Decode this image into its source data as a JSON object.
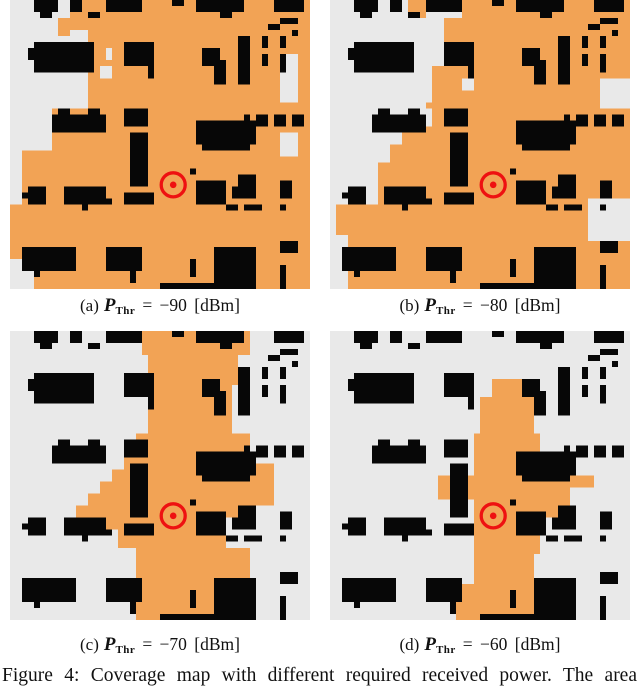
{
  "figure": {
    "caption": "Figure 4: Coverage map with different required received power. The area",
    "math": {
      "symbol": "P",
      "subscript": "Thr"
    },
    "panels": [
      {
        "label": "(a)",
        "rest": "= −90 [dBm]",
        "threshold_dbm": -90,
        "coverage": [
          [
            13,
            0,
            37,
            48
          ],
          [
            10,
            0,
            3,
            5
          ],
          [
            8,
            3,
            2,
            3
          ],
          [
            7,
            18,
            6,
            30
          ],
          [
            2,
            25,
            5,
            23
          ],
          [
            0,
            34,
            2,
            9
          ]
        ],
        "gray_patches": [
          [
            45,
            9,
            3,
            8
          ],
          [
            45,
            22,
            3,
            4
          ],
          [
            0,
            43,
            2,
            5
          ],
          [
            2,
            45,
            2,
            3
          ],
          [
            16,
            8,
            1,
            2
          ],
          [
            15,
            11,
            2,
            2
          ]
        ]
      },
      {
        "label": "(b)",
        "rest": "= −80 [dBm]",
        "threshold_dbm": -80,
        "coverage": [
          [
            22,
            0,
            28,
            48
          ],
          [
            19,
            3,
            3,
            45
          ],
          [
            17,
            11,
            2,
            37
          ],
          [
            13,
            0,
            3,
            3
          ],
          [
            16,
            17,
            1,
            1
          ],
          [
            12,
            21,
            5,
            27
          ],
          [
            10,
            24,
            2,
            24
          ],
          [
            8,
            27,
            2,
            21
          ],
          [
            1,
            34,
            7,
            5
          ],
          [
            3,
            39,
            9,
            9
          ]
        ],
        "gray_patches": [
          [
            45,
            13,
            5,
            5
          ],
          [
            43,
            33,
            7,
            7
          ],
          [
            22,
            13,
            2,
            2
          ]
        ]
      },
      {
        "label": "(c)",
        "rest": "= −70 [dBm]",
        "threshold_dbm": -70,
        "coverage": [
          [
            22,
            0,
            18,
            4
          ],
          [
            23,
            4,
            15,
            5
          ],
          [
            23,
            9,
            14,
            8
          ],
          [
            21,
            17,
            19,
            3
          ],
          [
            19,
            20,
            21,
            3
          ],
          [
            17,
            23,
            23,
            2
          ],
          [
            15,
            25,
            25,
            2
          ],
          [
            13,
            27,
            27,
            2
          ],
          [
            11,
            29,
            25,
            2
          ],
          [
            16,
            31,
            20,
            2
          ],
          [
            18,
            33,
            18,
            3
          ],
          [
            21,
            36,
            19,
            6
          ],
          [
            22,
            42,
            17,
            3
          ],
          [
            21,
            45,
            16,
            3
          ],
          [
            40,
            22,
            4,
            7
          ],
          [
            36,
            28,
            5,
            3
          ]
        ],
        "gray_patches": [
          [
            34,
            12,
            2,
            2
          ]
        ]
      },
      {
        "label": "(d)",
        "rest": "= −60 [dBm]",
        "threshold_dbm": -60,
        "coverage": [
          [
            27,
            8,
            5,
            3
          ],
          [
            25,
            11,
            9,
            6
          ],
          [
            24,
            17,
            11,
            7
          ],
          [
            18,
            24,
            6,
            4
          ],
          [
            24,
            23,
            12,
            4
          ],
          [
            36,
            24,
            8,
            2
          ],
          [
            24,
            25,
            11,
            12
          ],
          [
            35,
            26,
            5,
            5
          ],
          [
            24,
            37,
            10,
            7
          ],
          [
            21,
            42,
            3,
            6
          ],
          [
            22,
            42,
            13,
            6
          ]
        ],
        "gray_patches": []
      }
    ]
  },
  "map": {
    "grid": {
      "cols": 50,
      "rows": 48
    },
    "colors": {
      "covered": "#F2A355",
      "uncovered": "#E9E9E9",
      "building": "#070707",
      "marker": "#EE1111",
      "page_bg": "#FFFFFF"
    },
    "tx_marker": {
      "cx": 27.2,
      "cy": 30.7,
      "ring_r": 2.0,
      "ring_stroke": 0.55,
      "dot_r": 0.55
    },
    "buildings": [
      [
        4,
        0,
        4,
        2
      ],
      [
        5,
        2,
        2,
        1
      ],
      [
        10,
        0,
        2,
        2
      ],
      [
        13,
        2,
        2,
        1
      ],
      [
        16,
        0,
        2,
        2
      ],
      [
        18,
        0,
        4,
        2
      ],
      [
        27,
        0,
        2,
        1
      ],
      [
        31,
        0,
        8,
        2
      ],
      [
        35,
        2,
        2,
        1
      ],
      [
        44,
        0,
        5,
        2
      ],
      [
        45,
        3,
        3,
        1
      ],
      [
        43,
        4,
        2,
        1
      ],
      [
        47,
        5,
        1,
        1
      ],
      [
        4,
        7,
        10,
        5
      ],
      [
        3,
        8,
        1,
        2
      ],
      [
        19,
        7,
        5,
        4
      ],
      [
        23,
        7,
        1,
        2
      ],
      [
        23,
        11,
        1,
        2
      ],
      [
        32,
        8,
        3,
        3
      ],
      [
        34,
        10,
        2,
        4
      ],
      [
        38,
        6,
        2,
        8
      ],
      [
        42,
        6,
        1,
        2
      ],
      [
        42,
        9,
        1,
        2
      ],
      [
        45,
        6,
        1,
        2
      ],
      [
        45,
        9,
        1,
        3
      ],
      [
        7,
        19,
        9,
        3
      ],
      [
        8,
        18,
        2,
        1
      ],
      [
        13,
        18,
        2,
        1
      ],
      [
        19,
        18,
        4,
        3
      ],
      [
        20,
        22,
        3,
        9
      ],
      [
        19,
        32,
        5,
        2
      ],
      [
        31,
        20,
        10,
        4
      ],
      [
        32,
        24,
        8,
        1
      ],
      [
        39,
        19,
        1,
        1
      ],
      [
        41,
        19,
        2,
        2
      ],
      [
        44,
        19,
        2,
        2
      ],
      [
        47,
        19,
        2,
        2
      ],
      [
        30,
        28,
        1,
        1
      ],
      [
        31,
        30,
        5,
        4
      ],
      [
        37,
        31,
        1,
        2
      ],
      [
        38,
        29,
        3,
        4
      ],
      [
        36,
        34,
        2,
        1
      ],
      [
        39,
        34,
        3,
        1
      ],
      [
        45,
        30,
        2,
        3
      ],
      [
        45,
        34,
        1,
        1
      ],
      [
        3,
        31,
        3,
        3
      ],
      [
        2,
        32,
        1,
        1
      ],
      [
        9,
        31,
        7,
        3
      ],
      [
        12,
        34,
        1,
        1
      ],
      [
        16,
        33,
        1,
        1
      ],
      [
        2,
        41,
        9,
        4
      ],
      [
        4,
        45,
        1,
        1
      ],
      [
        16,
        41,
        6,
        4
      ],
      [
        30,
        43,
        1,
        3
      ],
      [
        34,
        41,
        7,
        7
      ],
      [
        20,
        44,
        1,
        3
      ],
      [
        45,
        40,
        3,
        2
      ],
      [
        45,
        44,
        1,
        4
      ],
      [
        25,
        47,
        10,
        1
      ]
    ]
  }
}
